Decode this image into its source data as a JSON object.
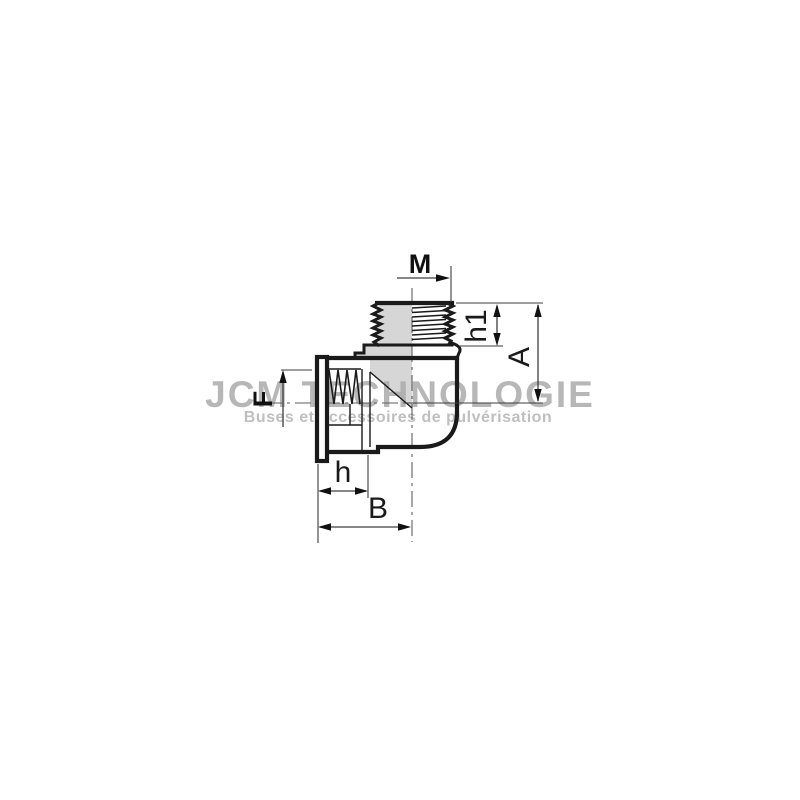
{
  "drawing": {
    "kind": "90-degree elbow fitting, half-section technical drawing",
    "labels": {
      "male_thread": "M",
      "male_thread_length": "h1",
      "overall_height": "A",
      "female_thread": "F",
      "socket_depth": "h",
      "overall_length": "B"
    },
    "watermark": {
      "title": "JCM TECHNOLOGIE",
      "subtitle": "Buses et accessoires de pulvérisation"
    },
    "colors": {
      "line": "#1a1a1a",
      "dimension": "#3d3d3d",
      "section_fill": "#d6d6d6",
      "watermark": "#ababab",
      "background": "#ffffff"
    }
  }
}
